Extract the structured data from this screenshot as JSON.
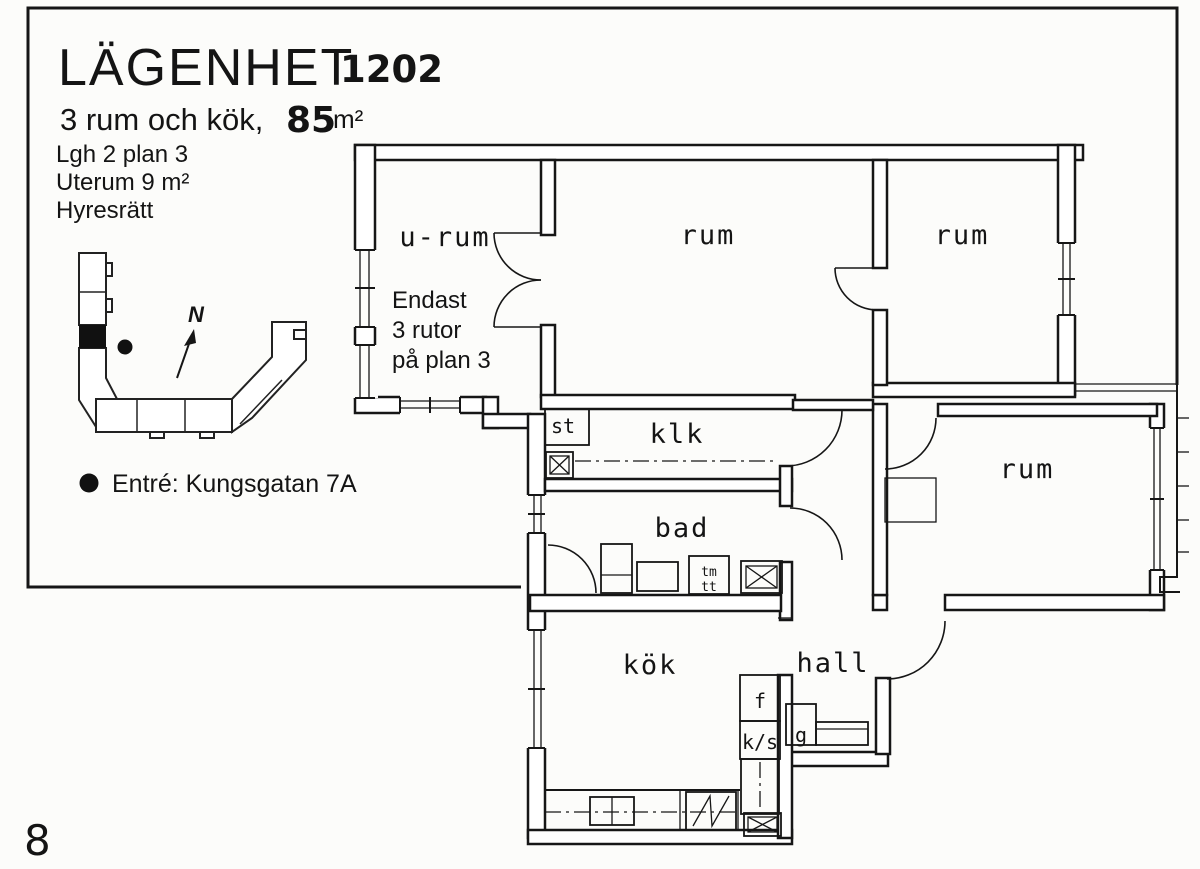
{
  "header": {
    "title": "LÄGENHET",
    "apartment_number": "1202",
    "rooms_line": "3 rum och kök,",
    "area_value": "85",
    "area_unit": "m²",
    "detail_lines": {
      "line1": "Lgh 2 plan 3",
      "line2": "Uterum 9 m²",
      "line3": "Hyresrätt"
    }
  },
  "site_plan": {
    "north_label": "N",
    "entrance_note": "Entré: Kungsgatan 7A"
  },
  "floor_plan": {
    "rooms": {
      "urum": "u-rum",
      "rum_top_middle": "rum",
      "rum_top_right": "rum",
      "rum_right": "rum",
      "klk": "klk",
      "st": "st",
      "bad": "bad",
      "kok": "kök",
      "hall": "hall"
    },
    "note": {
      "line1": "Endast",
      "line2": "3 rutor",
      "line3": "på plan 3"
    },
    "fixtures": {
      "f": "f",
      "ks": "k/s",
      "g": "g",
      "tm": "tm",
      "tt": "tt"
    }
  },
  "page_number": "8"
}
